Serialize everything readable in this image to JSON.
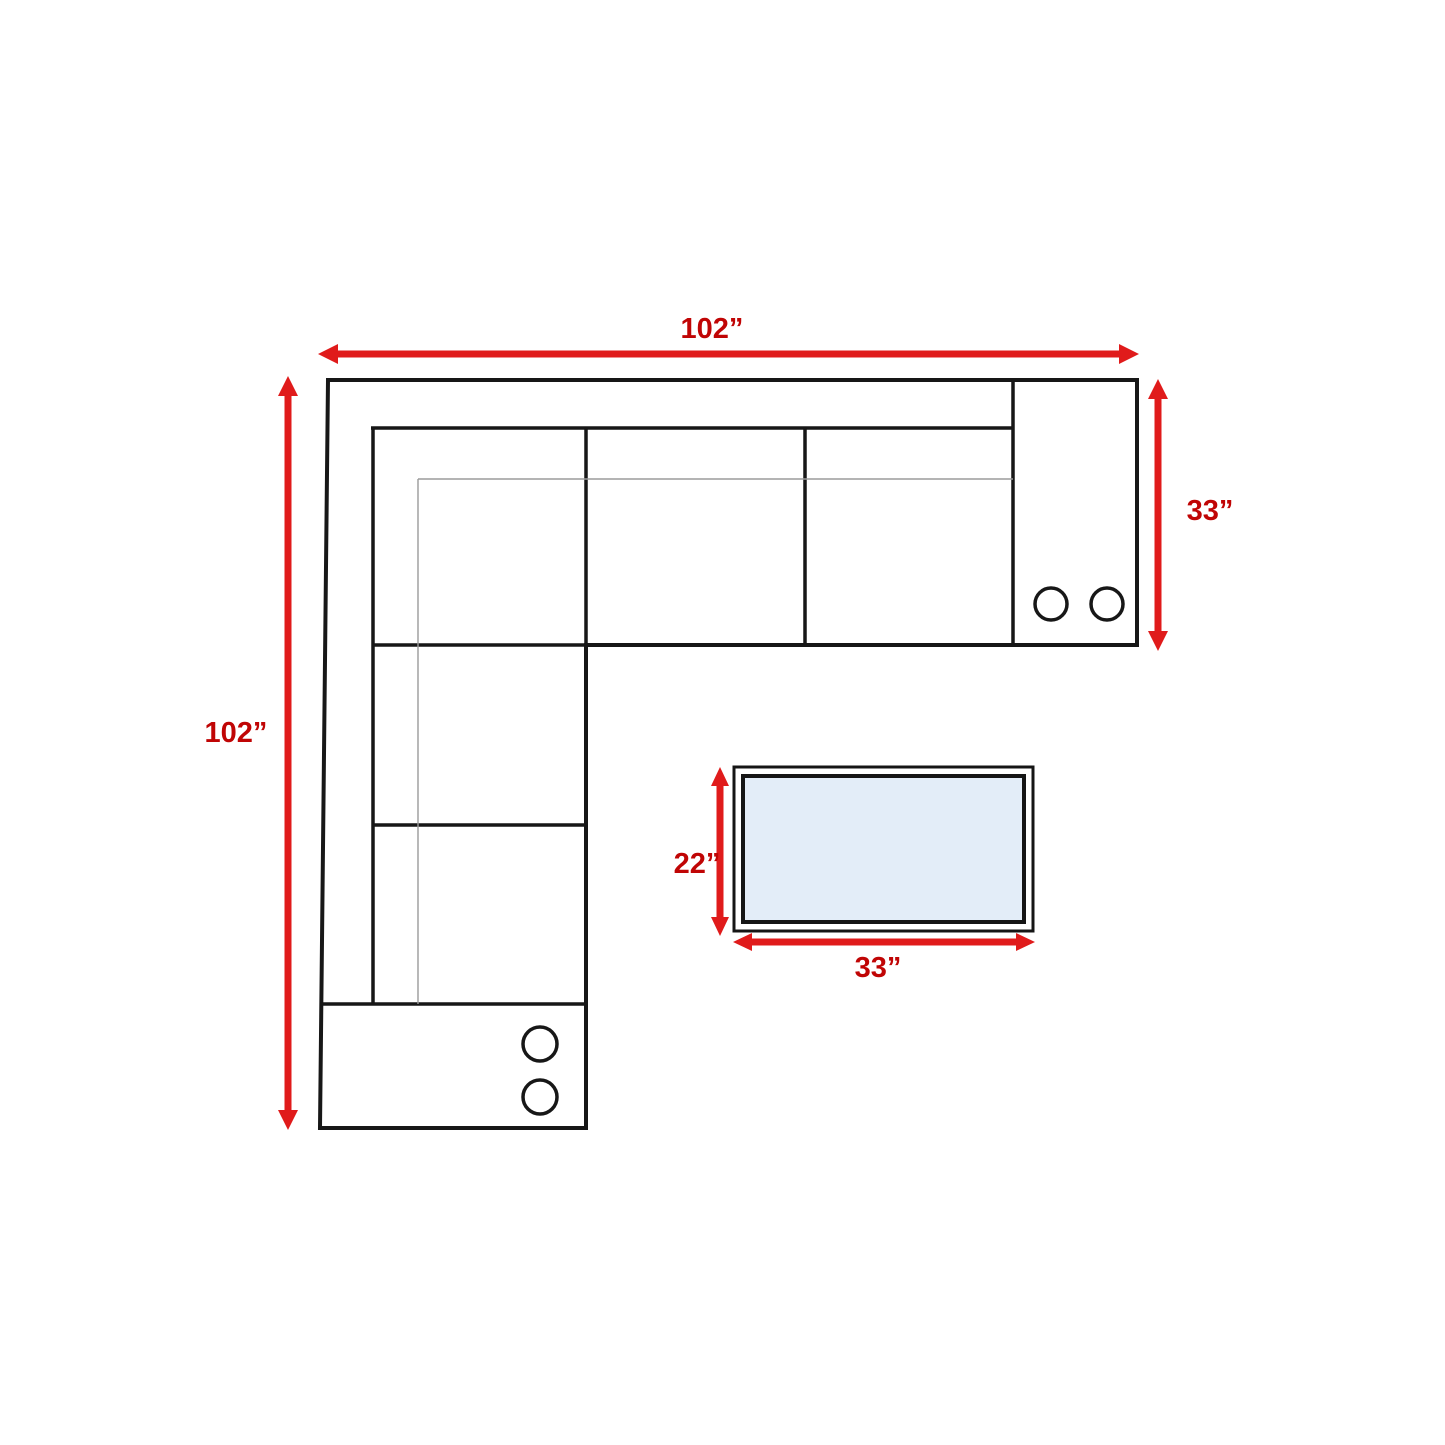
{
  "diagram": {
    "kind": "sectional-sofa-floor-plan-with-dimensions",
    "units": "inches",
    "dimensions": {
      "sofa_width": "102”",
      "sofa_depth": "102”",
      "arm_depth": "33”",
      "table_depth": "22”",
      "table_width": "33”"
    },
    "cup_holders": {
      "right_console_count": 2,
      "bottom_console_count": 2
    },
    "colors": {
      "arrow_red": "#e01b1b",
      "label_red": "#c00505",
      "outline_black": "#171717",
      "thin_line_gray": "#9b9b9b",
      "table_fill_blue": "#e3edf8",
      "background": "#ffffff"
    }
  }
}
